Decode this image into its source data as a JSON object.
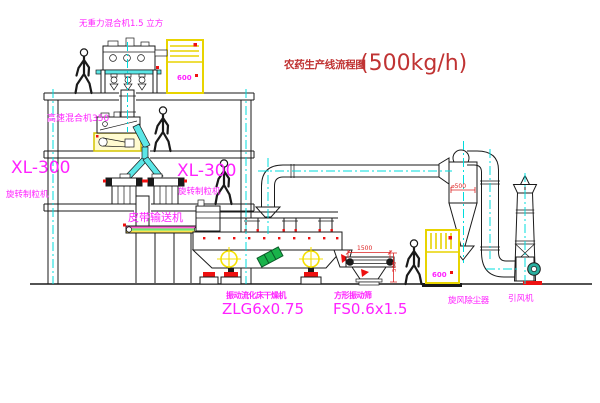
{
  "title": {
    "text": "农药生产线流程图",
    "capacity": "(500kg/h)"
  },
  "equipment_labels": {
    "gravity_free_mixer": "无重力混合机1.5 立方",
    "high_speed_mixer": "高速混合机350",
    "granulator_left_model": "XL-300",
    "granulator_left_name": "旋转制粒机",
    "granulator_right_model": "XL-300",
    "granulator_right_name": "旋转制粒机",
    "belt_conveyor": "皮带输送机",
    "fluid_bed_dryer_name": "振动流化床干燥机",
    "fluid_bed_dryer_model": "ZLG6x0.75",
    "square_sieve_name": "方形振动筛",
    "square_sieve_model": "FS0.6x1.5",
    "cyclone_collector": "旋风除尘器",
    "induced_draft_fan": "引风机"
  },
  "dimension_annotations": {
    "sieve_length": "1500",
    "sieve_height": "500",
    "cyclone_diameter": "⌀500"
  },
  "control_cabinets": {
    "upper_text": "600",
    "lower_text": "600"
  },
  "colors": {
    "label_magenta": "#ff22ff",
    "title_red": "#c03333",
    "centerline_cyan": "#00dcdc",
    "highlight_yellow": "#e8d400",
    "accent_red": "#ee1111",
    "motor_green": "#19b34a",
    "fan_teal": "#2aaf9f"
  }
}
